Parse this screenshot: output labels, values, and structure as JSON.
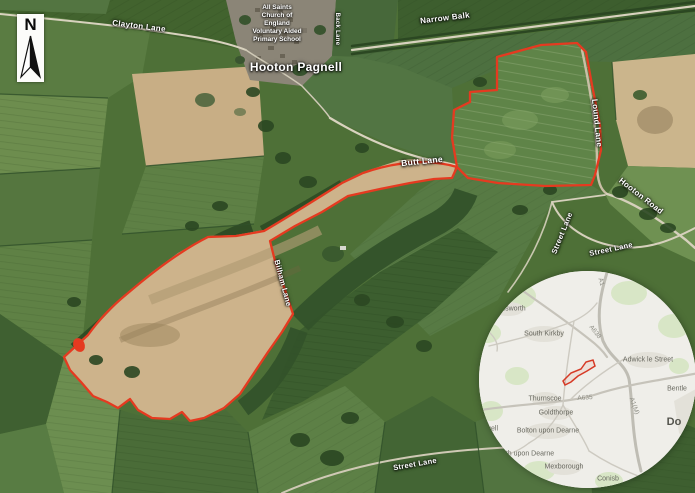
{
  "north_arrow": {
    "label": "N"
  },
  "main_map": {
    "place_labels": {
      "village": "Hooton Pagnell",
      "school_l1": "All Saints",
      "school_l2": "Church of",
      "school_l3": "England",
      "school_l4": "Voluntary Aided",
      "school_l5": "Primary School"
    },
    "road_labels": {
      "clayton_lane": "Clayton Lane",
      "narrow_balk": "Narrow Balk",
      "back_lane": "Back Lane",
      "butt_lane": "Butt Lane",
      "lound_lane": "Lound Lane",
      "hooton_road": "Hooton Road",
      "street_lane_upper": "Street Lane",
      "street_lane_lower": "Street Lane",
      "street_lane_south": "Street Lane",
      "bilham_lane": "Bilham Lane"
    }
  },
  "inset_map": {
    "towns": {
      "hemsworth": "Hemsworth",
      "south_kirkby": "South Kirkby",
      "adwick_le_street": "Adwick le Street",
      "thurnscoe": "Thurnscoe",
      "goldthorpe": "Goldthorpe",
      "bolton_upon_dearne": "Bolton upon Dearne",
      "wath_upon_dearne_fragment": "th upon Dearne",
      "mexborough": "Mexborough",
      "conisbrough_fragment": "Conisb",
      "doncaster_fragment": "Do",
      "bentley_fragment": "Bentle",
      "left_edge_fragment": "well"
    },
    "roads": {
      "a1": "A1",
      "a638": "A638",
      "a635": "A635",
      "a1m": "A1(M)"
    }
  },
  "colors": {
    "site_boundary": "#e53a20",
    "road_label_text": "#ffffff",
    "inset_background": "#efeee9"
  }
}
